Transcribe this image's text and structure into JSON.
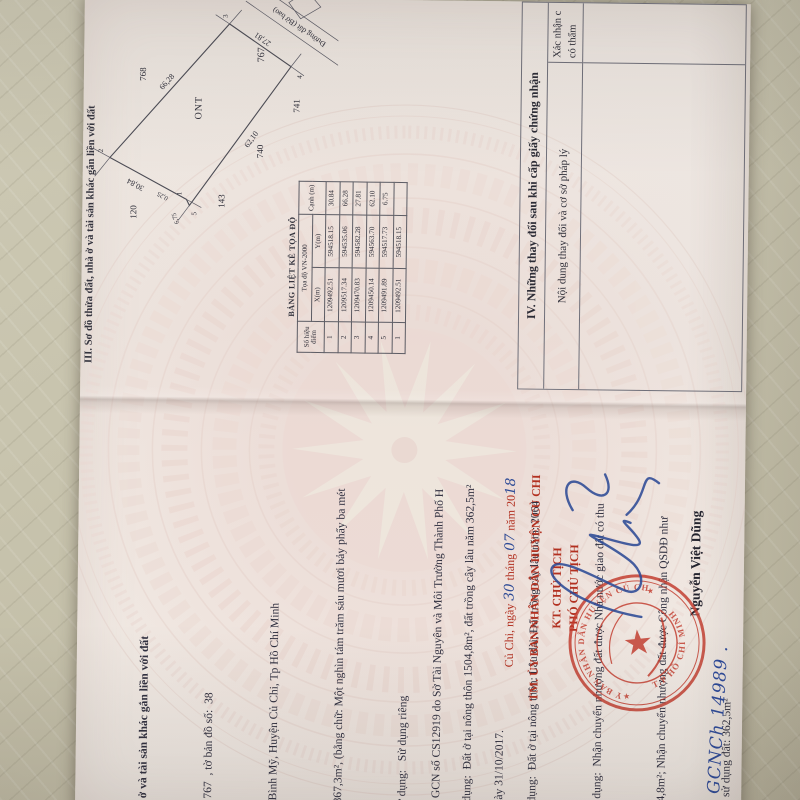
{
  "colors": {
    "red_text": "#b23020",
    "stamp_red": "#c23a2c",
    "pen_blue": "#2d4a96",
    "paper": "#efe8e2",
    "fabric": "#c8c4ae",
    "ink": "#34343e"
  },
  "handwritten_code": "GCNCh 14989 .",
  "left_page": {
    "lines": [
      "à ở và tài sản khác gắn liền với đất",
      ":  767  , tờ bản đồ số:  38",
      "ã Bình Mỹ, Huyện Củ Chi, Tp Hồ Chí Minh",
      "1867,3m², (bằng chữ: Một nghìn tám trăm sáu mươi bảy phẩy ba mét",
      "sử dụng:   Sử dụng riêng",
      "ử dụng:  Đất ở tại nông thôn 1504,8m², đất trồng cây lâu năm 362,5m²",
      "ử dụng:  Đất ở tại nông thôn: Lâu dài; Đất trồng cây lâu năm: 2064",
      "sử dụng:  Nhận chuyển nhượng đất được Nhà nước giao đất có thu",
      "504,8m²; Nhận chuyển nhượng đất được Công nhận QSDĐ như",
      "iền sử dụng đất: 362,5m²",
      "ây dựng khác: -/-.",
      "ất là rừng trồng: -/-."
    ],
    "origin_lines": [
      "từ GCN số CS12919 do Sở Tài Nguyên và Môi Trường Thành Phố H",
      "ngày 31/10/2017."
    ],
    "date": {
      "place": "Củ Chi, ngày ",
      "day": "30",
      "thang": " tháng ",
      "month": "07",
      "nam": " năm 20",
      "year": "18"
    },
    "authority": "TM. ỦY BAN NHÂN DÂN HUYỆN CỦ CHI",
    "kt_line": "KT. CHỦ TỊCH",
    "vice_line": "PHÓ CHỦ TỊCH",
    "signer_name": "Nguyễn Việt Dũng",
    "stamp": {
      "ring_top": "ỦY BAN NHÂN DÂN HUYỆN CỦ CHI",
      "ring_bottom": "T.P HỒ CHÍ MINH",
      "star": "★"
    }
  },
  "right_page": {
    "section3_title": "III. Sơ đồ thửa đất, nhà ở và tài sản khác gắn liền với đất",
    "coord_table": {
      "title": "BẢNG LIỆT KÊ TỌA ĐỘ",
      "col_point": "Số hiệu điểm",
      "col_group": "Tọa độ VN-2000",
      "col_x": "X(m)",
      "col_y": "Y(m)",
      "col_edge": "Cạnh (m)",
      "rows": [
        [
          "1",
          "1209492.51",
          "594518.15",
          "30.84"
        ],
        [
          "2",
          "1209517.34",
          "594535.06",
          "66.28"
        ],
        [
          "3",
          "1209470.83",
          "594582.28",
          "27.81"
        ],
        [
          "4",
          "1209450.14",
          "594563.70",
          "62.10"
        ],
        [
          "5",
          "1209491.89",
          "594517.73",
          "6.75"
        ],
        [
          "1",
          "1209492.51",
          "594518.15",
          ""
        ]
      ]
    },
    "diagram": {
      "parcel": "767",
      "land_use": "ONT",
      "road": "Đường đất (Bờ bao)",
      "e12": "30,84",
      "e23": "66,28",
      "e34": "27,81",
      "e45": "62,10",
      "e51": "6,75",
      "offset": "0,25",
      "v1": "1",
      "v2": "2",
      "v3": "3",
      "v4": "4",
      "v5": "5",
      "n_top": "120",
      "n_left": "143",
      "n_left2": "740",
      "n_left3": "741",
      "n_right": "768"
    },
    "section4": {
      "title": "IV. Những thay đổi sau khi cấp giấy chứng nhận",
      "col1": "Nội dung thay đổi và cơ sở pháp lý",
      "col2a": "Xác nhận c",
      "col2b": "có thẩm"
    }
  }
}
